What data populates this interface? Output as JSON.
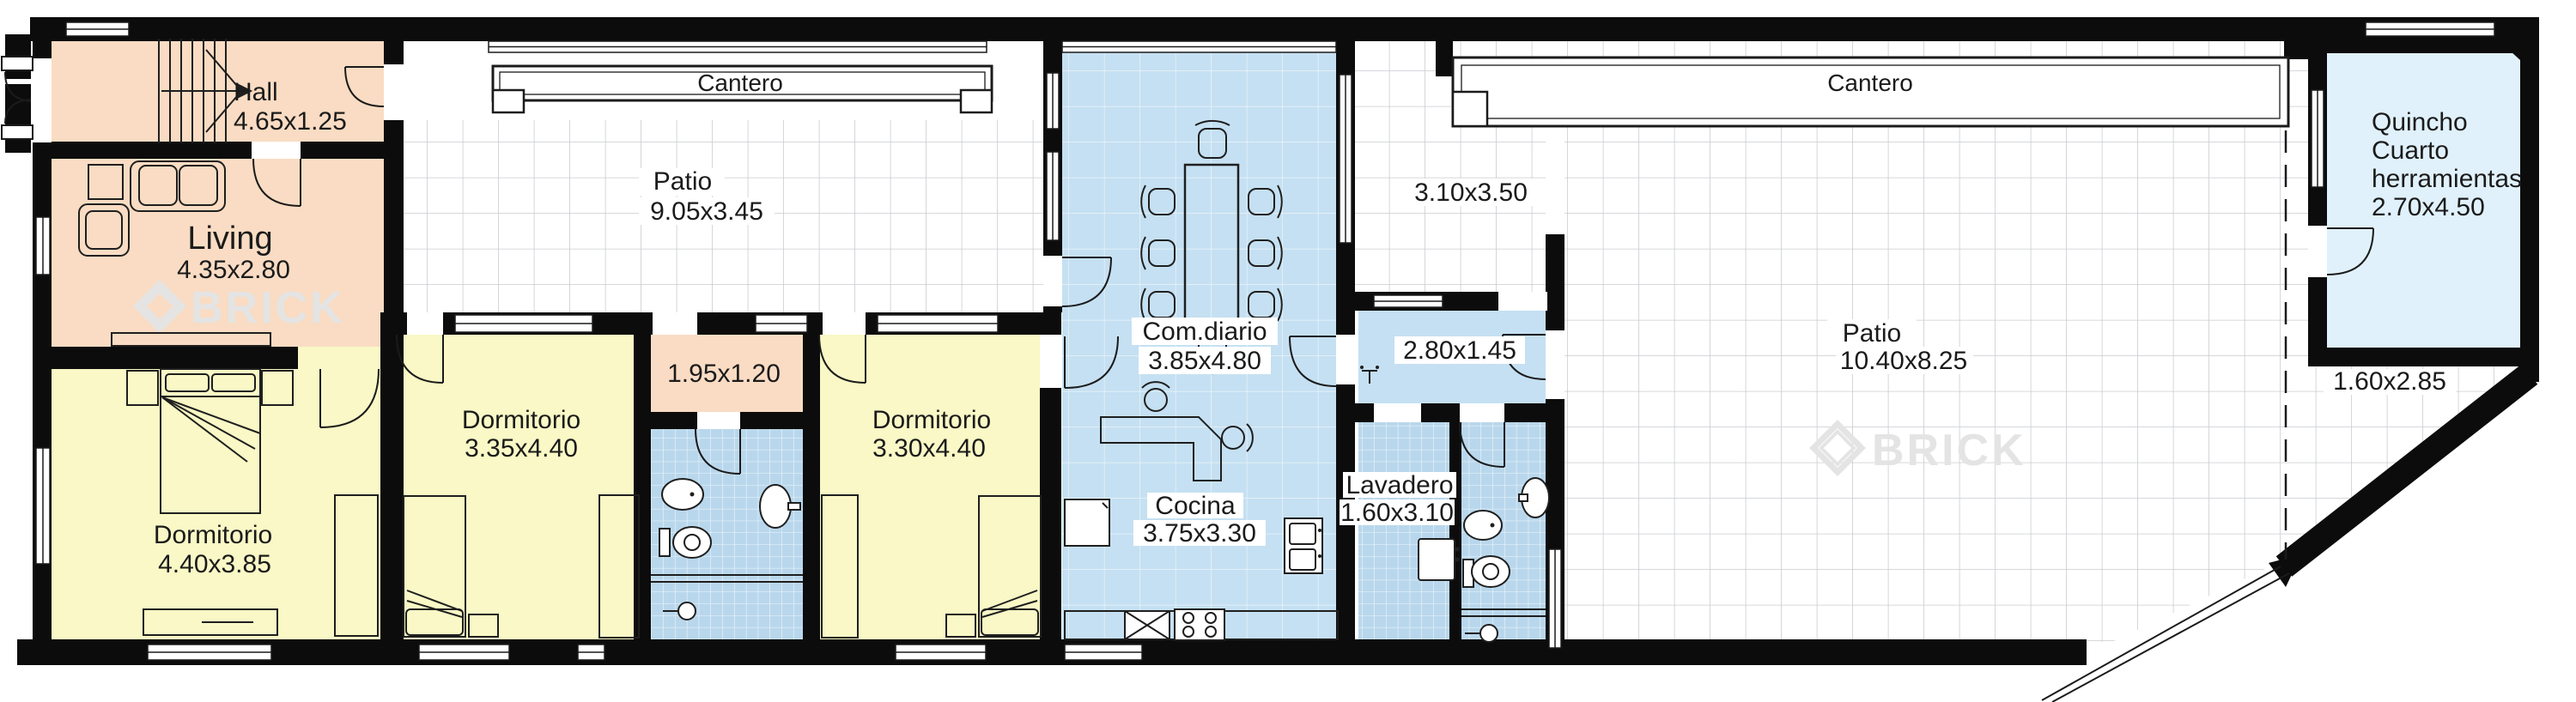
{
  "plan": {
    "watermark": "BRICK",
    "palette": {
      "wall": "#0c0c0c",
      "peach": "#f9dcc3",
      "yellow": "#f9f8c6",
      "blue_room": "#c5e0f2",
      "bath_tile": "#b9d7ec",
      "quincho_blue": "#e0f1fb",
      "tile_grid_line": "#c9ccd0"
    },
    "rooms": {
      "hall": {
        "name": "Hall",
        "dims": "4.65x1.25"
      },
      "living": {
        "name": "Living",
        "dims": "4.35x2.80"
      },
      "patio_left": {
        "name": "Patio",
        "dims": "9.05x3.45"
      },
      "cantero_left": {
        "label": "Cantero"
      },
      "cantero_right": {
        "label": "Cantero"
      },
      "dorm1": {
        "name": "Dormitorio",
        "dims": "4.40x3.85"
      },
      "dorm2": {
        "name": "Dormitorio",
        "dims": "3.35x4.40"
      },
      "dorm3": {
        "name": "Dormitorio",
        "dims": "3.30x4.40"
      },
      "pass_beds": {
        "dims": "1.95x1.20"
      },
      "comdiario": {
        "name": "Com.diario",
        "dims": "3.85x4.80"
      },
      "cocina": {
        "name": "Cocina",
        "dims": "3.75x3.30"
      },
      "lavadero": {
        "name": "Lavadero",
        "dims": "1.60x3.10"
      },
      "pass_patio": {
        "dims": "2.80x1.45"
      },
      "courtyard": {
        "dims": "3.10x3.50"
      },
      "patio_right": {
        "name": "Patio",
        "dims": "10.40x8.25"
      },
      "quincho": {
        "line1": "Quincho",
        "line2": "Cuarto",
        "line3": "herramientas",
        "dims": "2.70x4.50"
      },
      "side_strip": {
        "dims": "1.60x2.85"
      }
    }
  }
}
